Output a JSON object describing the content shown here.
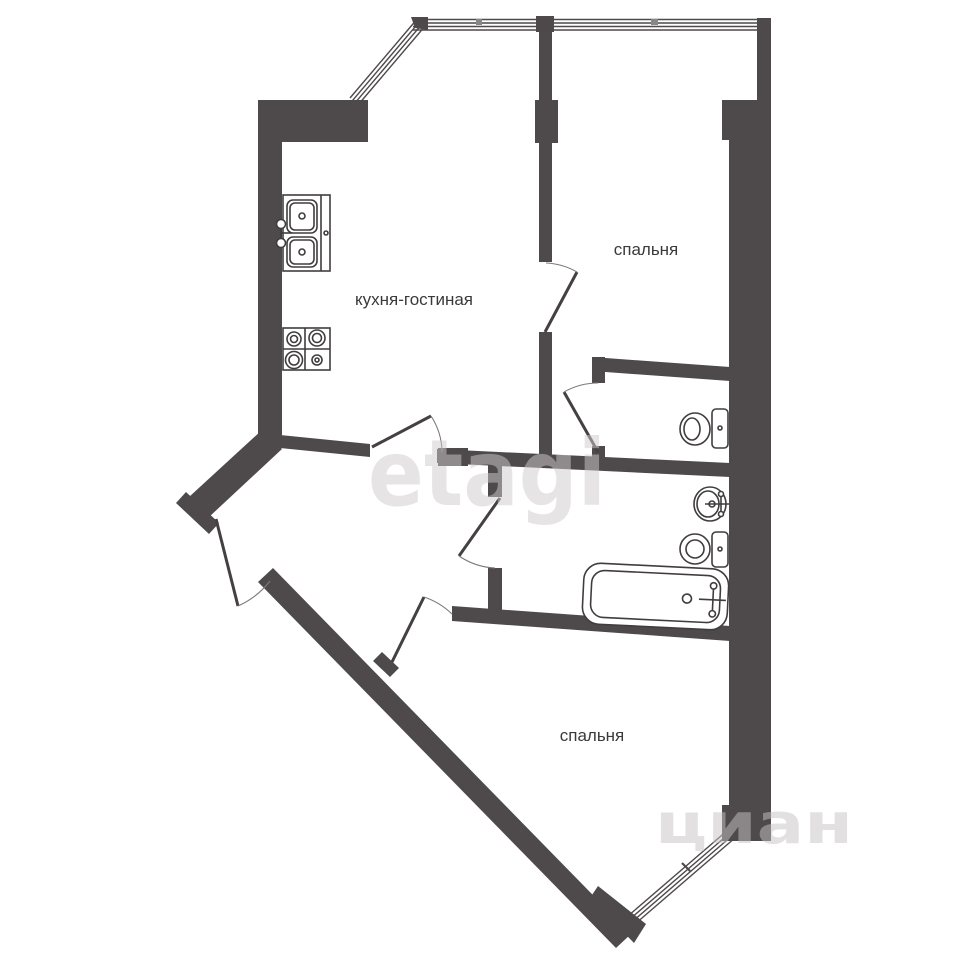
{
  "plan": {
    "rooms": [
      {
        "id": "kitchen-living",
        "label": "кухня-гостиная"
      },
      {
        "id": "bedroom-top",
        "label": "спальня"
      },
      {
        "id": "bedroom-bottom",
        "label": "спальня"
      }
    ],
    "fixtures": [
      "kitchen-double-sink",
      "stove-4-burners",
      "wc-toilet",
      "bathroom-washbasin",
      "bathroom-toilet",
      "bathtub"
    ],
    "doors": [
      "entrance-door",
      "kitchen-hall-door",
      "bedroom-top-door",
      "wc-door",
      "bathroom-door",
      "bedroom-bottom-door"
    ],
    "windows": [
      "bay-window-top-left",
      "top-window",
      "angled-window-bottom-right"
    ],
    "watermarks": [
      {
        "text": "etagi"
      },
      {
        "text": "циан"
      }
    ],
    "colors": {
      "wall": "#4e494b",
      "fixture_stroke": "#413d3f",
      "label_text": "#3a3a3a",
      "background": "#ffffff",
      "watermark": "#d0cbcc"
    }
  }
}
